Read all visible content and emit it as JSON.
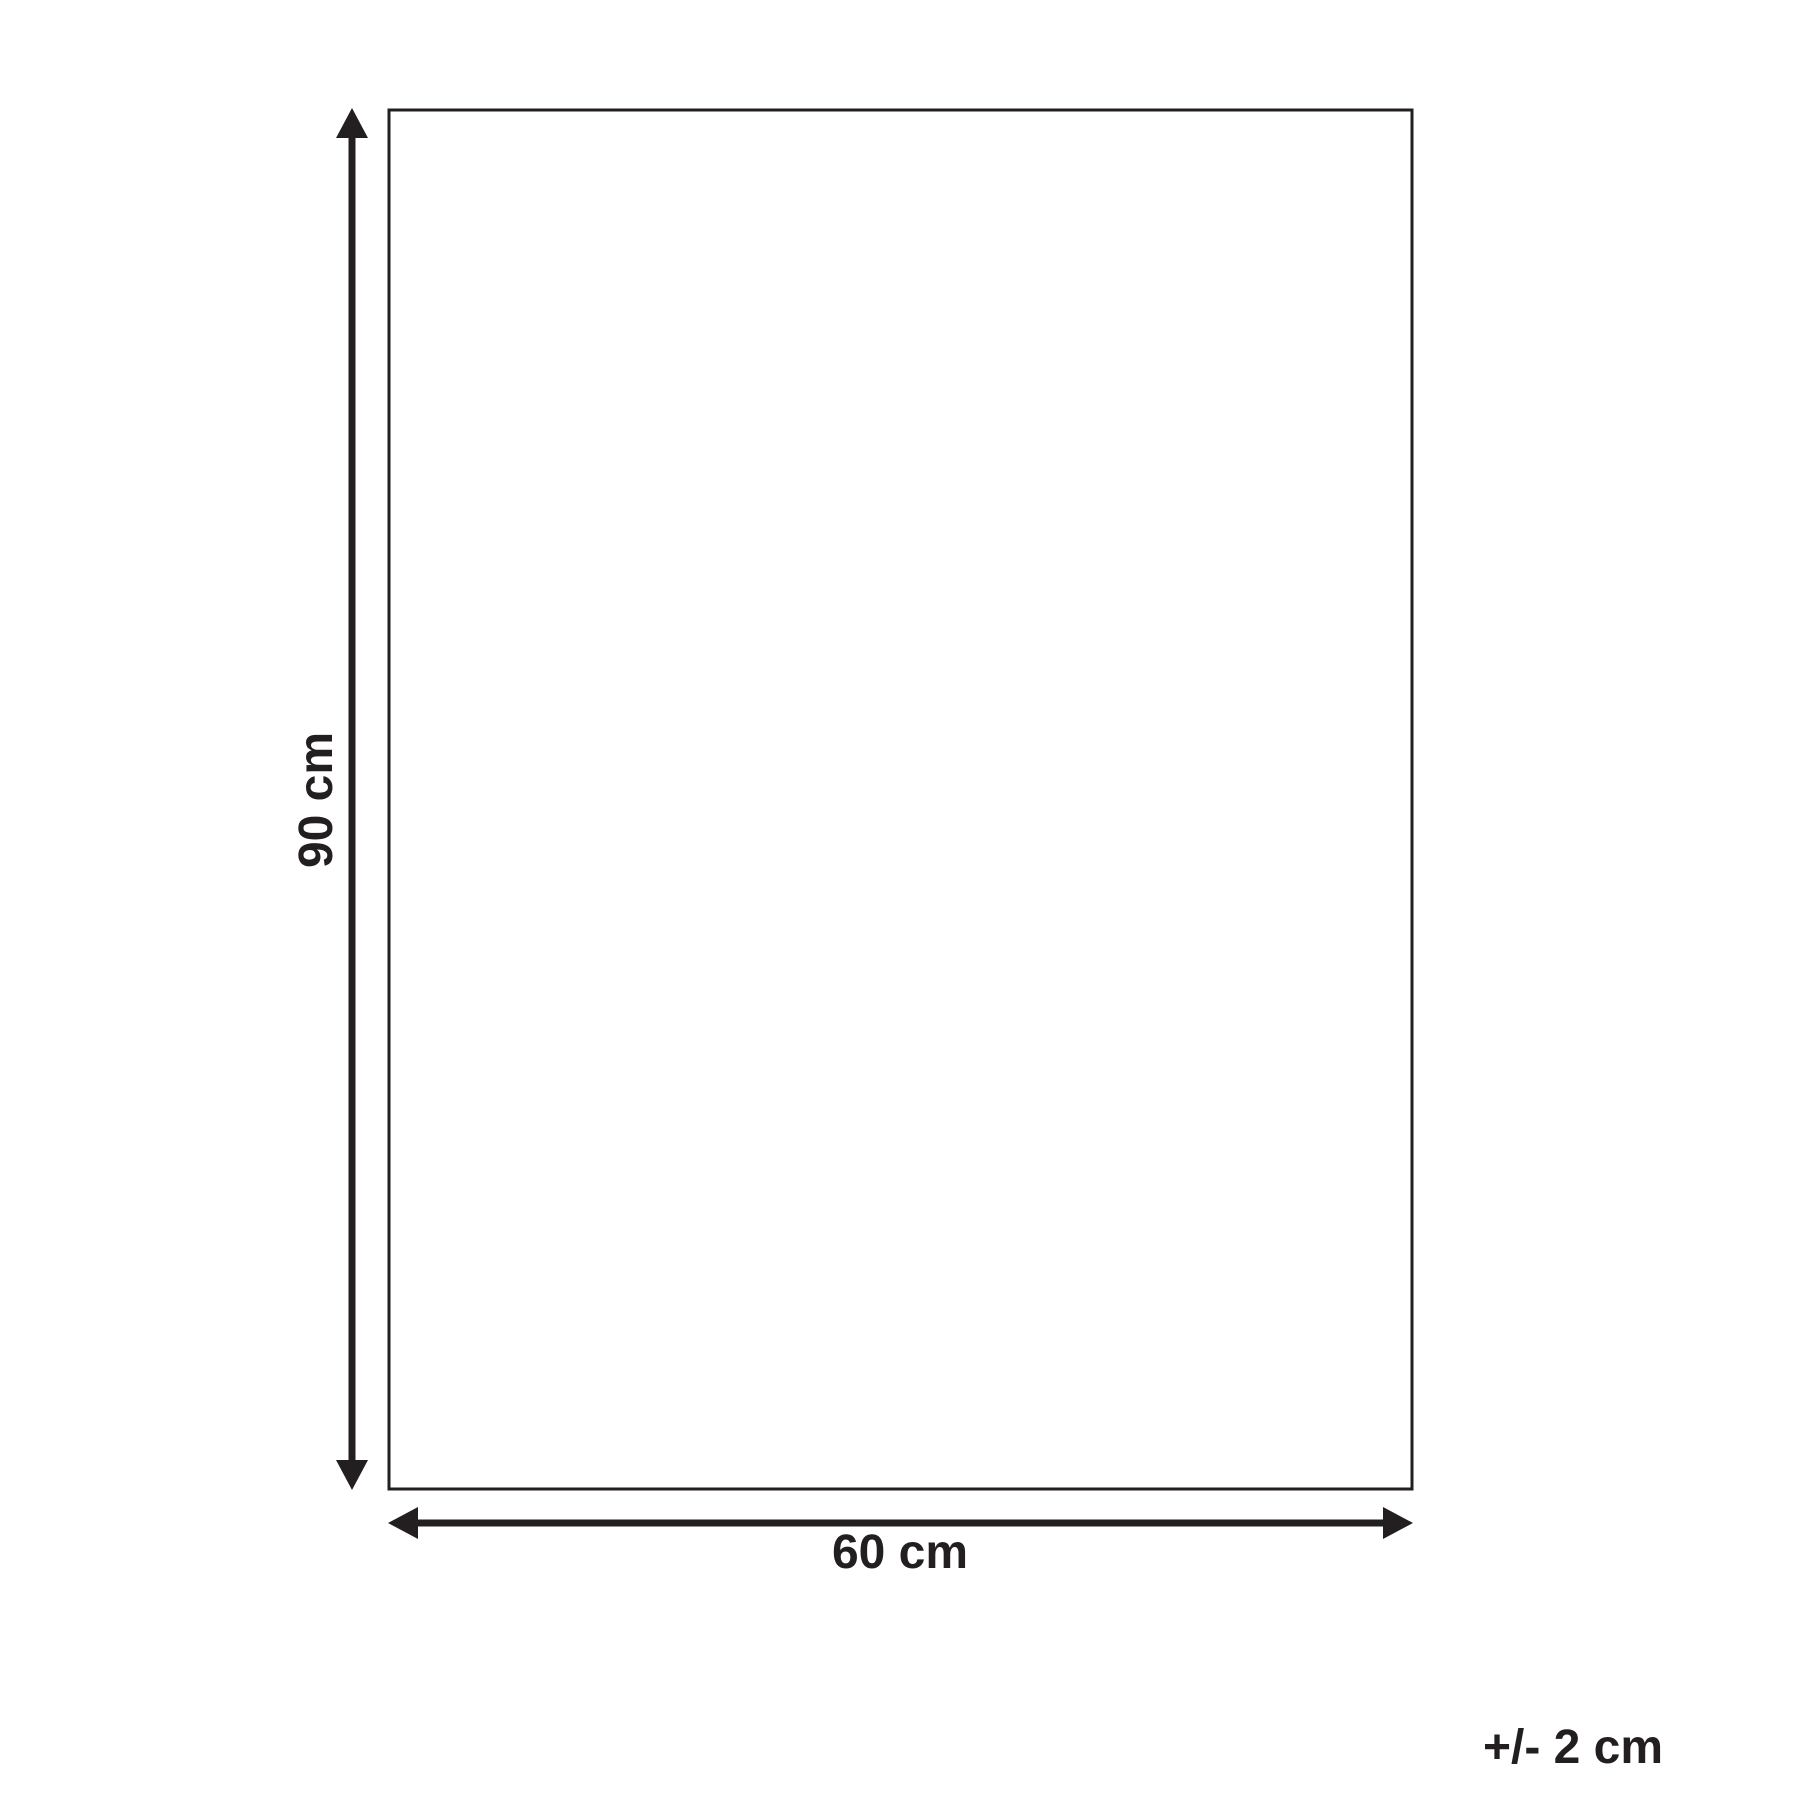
{
  "diagram": {
    "type": "product-dimension-diagram",
    "height_label": "90 cm",
    "width_label": "60 cm",
    "tolerance_label": "+/- 2 cm",
    "line_color": "#231f20",
    "background_color": "#ffffff"
  }
}
